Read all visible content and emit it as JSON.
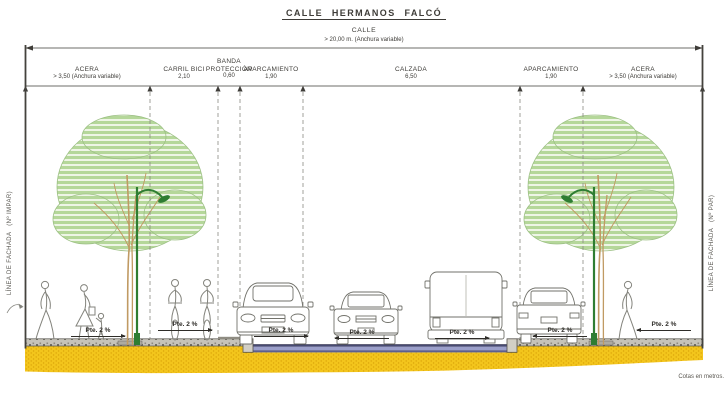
{
  "title": "CALLE HERMANOS FALCÓ",
  "overall_dimension": {
    "label": "CALLE",
    "value": "> 20,00 m. (Anchura variable)"
  },
  "zones": [
    {
      "label": "ACERA",
      "dimension": "> 3,50 (Anchura variable)"
    },
    {
      "label": "CARRIL BICI",
      "dimension": "2,10"
    },
    {
      "label": "BANDA PROTECCIÓN",
      "dimension": "0,60"
    },
    {
      "label": "APARCAMIENTO",
      "dimension": "1,90"
    },
    {
      "label": "CALZADA",
      "dimension": "6,50"
    },
    {
      "label": "APARCAMIENTO",
      "dimension": "1,90"
    },
    {
      "label": "ACERA",
      "dimension": "> 3,50 (Anchura variable)"
    }
  ],
  "facade_labels": {
    "left": "LÍNEA DE FACHADA   (Nº IMPAR)",
    "right": "LÍNEA DE FACHADA   (Nº PAR)"
  },
  "slopes": [
    {
      "label": "Pte. 2 %",
      "direction": "right"
    },
    {
      "label": "Pte. 2 %",
      "direction": "right"
    },
    {
      "label": "Pte. 2 %",
      "direction": "right"
    },
    {
      "label": "Pte. 2 %",
      "direction": "left"
    },
    {
      "label": "Pte. 2 %",
      "direction": "right"
    },
    {
      "label": "Pte. 2 %",
      "direction": "left"
    },
    {
      "label": "Pte. 2 %",
      "direction": "left"
    }
  ],
  "footnote": "Cotas en metros.",
  "colors": {
    "foliage_green": "#b5d79a",
    "lamp_green": "#2e7d32",
    "earth_yellow": "#f3c51c",
    "asphalt_blue": "#9b9fca",
    "paving_gray": "#c6c3b9",
    "line_dark": "#3e3c38"
  }
}
